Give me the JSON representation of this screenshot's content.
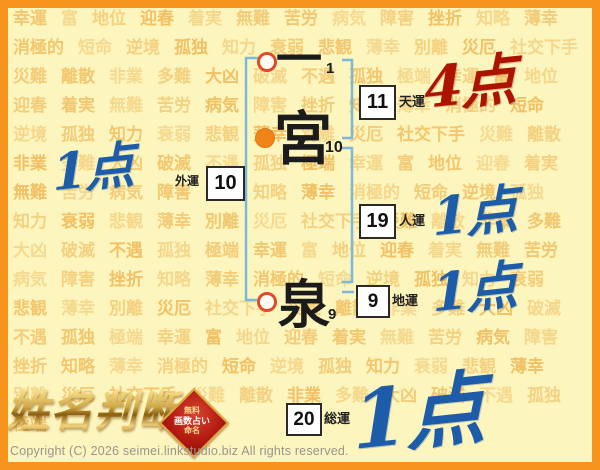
{
  "page": {
    "copyright": "Copyright (C) 2026 seimei.linkstudio.biz All rights reserved."
  },
  "logo": {
    "title": "姓名判断",
    "badge_lines": [
      "無料",
      "画数占い",
      "命名"
    ]
  },
  "name": {
    "characters": [
      {
        "char": "一",
        "strokes": "1",
        "mark": "ring"
      },
      {
        "char": "宮",
        "strokes": "10",
        "mark": "filled"
      },
      {
        "char": "泉",
        "strokes": "9",
        "mark": "ring"
      }
    ]
  },
  "fortunes": [
    {
      "id": "tenun",
      "label": "天運",
      "value": "11",
      "score": "4点",
      "score_color": "red"
    },
    {
      "id": "jinun",
      "label": "人運",
      "value": "19",
      "score": "1点",
      "score_color": "blue"
    },
    {
      "id": "chiun",
      "label": "地運",
      "value": "9",
      "score": "1点",
      "score_color": "blue"
    },
    {
      "id": "gaiun",
      "label": "外運",
      "value": "10",
      "score": "1点",
      "score_color": "blue"
    },
    {
      "id": "souun",
      "label": "総運",
      "value": "20",
      "score": "1点",
      "score_color": "blue"
    }
  ],
  "colors": {
    "frame_orange": "#f7941d",
    "background": "#fcf5be",
    "watermark_word": "#f0bf62",
    "bracket_blue": "#7cb8dc",
    "ring_mark": "#e0492a",
    "filled_mark": "#f08418",
    "score_red": "#ad1400",
    "score_blue": "#1d5ca8",
    "badge_red": "#b51d12",
    "logo_gold": "#d2a845"
  },
  "background": {
    "words": [
      "幸運",
      "富",
      "地位",
      "迎春",
      "着実",
      "無難",
      "苦労",
      "病気",
      "障害",
      "挫折",
      "知略",
      "薄幸",
      "消極的",
      "短命",
      "逆境",
      "孤独",
      "知力",
      "衰弱",
      "悲観",
      "薄幸",
      "別離",
      "災厄",
      "社交下手",
      "災難",
      "離散",
      "非業",
      "多難",
      "大凶",
      "破滅",
      "不遇",
      "孤独",
      "極端"
    ]
  }
}
